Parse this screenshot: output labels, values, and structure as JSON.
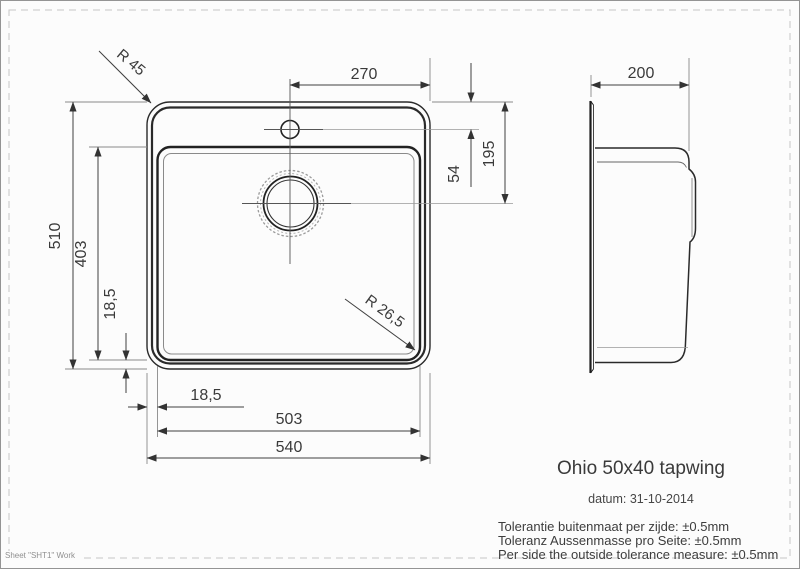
{
  "colors": {
    "outline": "#2a2a2a",
    "dimension": "#3f3f3f",
    "extension": "#8a8a8a",
    "faint": "#9a9a9a",
    "text": "#3a3a3a",
    "paper": "#fcfcfc"
  },
  "front_view": {
    "dim_tap_center_to_edge": "270",
    "dim_taphole_from_top": "54",
    "dim_drain_from_top": "195",
    "dim_outer_height": "510",
    "dim_bowl_height": "403",
    "dim_bottom_margin": "18,5",
    "dim_left_margin": "18,5",
    "dim_bowl_width": "503",
    "dim_outer_width": "540",
    "radius_outer_corner": "R 45",
    "radius_bowl_corner": "R 26,5"
  },
  "side_view": {
    "dim_depth": "200"
  },
  "title_block": {
    "title": "Ohio 50x40 tapwing",
    "date": "datum: 31-10-2014",
    "tolerance_nl": "Tolerantie buitenmaat per zijde: ±0.5mm",
    "tolerance_de": "Toleranz Aussenmasse pro Seite: ±0.5mm",
    "tolerance_en": "Per side the outside tolerance measure: ±0.5mm"
  },
  "sheet": {
    "label": "Sheet \"SHT1\" Work"
  }
}
